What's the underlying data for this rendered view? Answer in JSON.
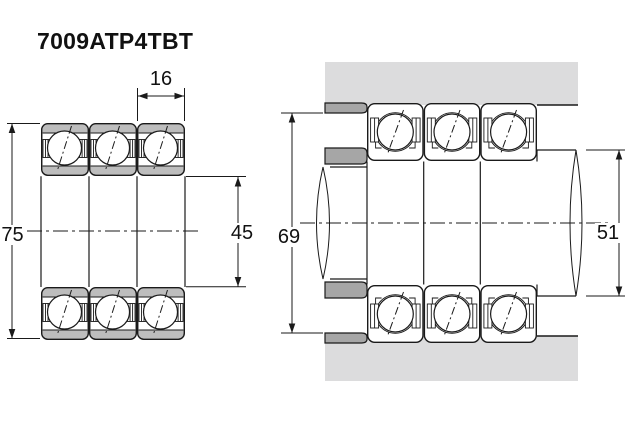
{
  "title": "7009ATP4TBT",
  "views": {
    "cross_section": {
      "outer_diameter": "75",
      "bore_diameter": "45",
      "bearing_width": "16"
    },
    "mounting": {
      "housing_abutment_diameter": "69",
      "shaft_abutment_diameter": "51"
    }
  },
  "colors": {
    "ring-gray": "#bdbdbd",
    "housing-gray": "#dcdcdd",
    "shoulder-gray": "#a6a6a6",
    "line": "#1a1a1a"
  }
}
